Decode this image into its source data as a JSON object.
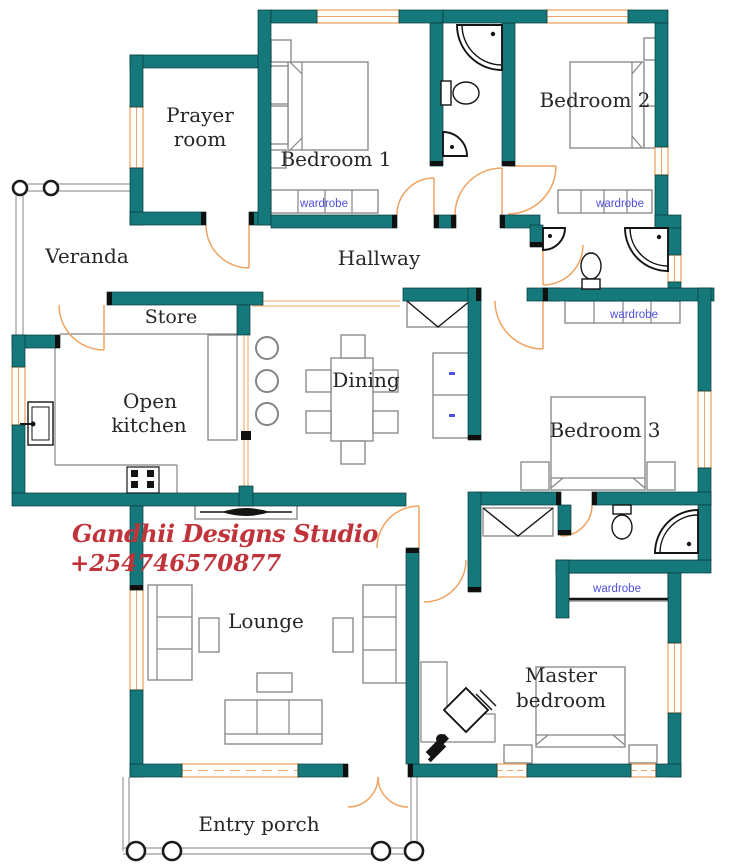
{
  "colors": {
    "wall": "#15797b",
    "window": "#efa463",
    "furniture": "#848484",
    "fixture": "#141414",
    "label": "#262626",
    "wardrobe_text": "#4f4fe0",
    "watermark": "#c0333a",
    "background": "#ffffff"
  },
  "rooms": {
    "prayer_room": {
      "line1": "Prayer",
      "line2": "room"
    },
    "bedroom1": {
      "label": "Bedroom 1"
    },
    "bedroom2": {
      "label": "Bedroom 2"
    },
    "veranda": {
      "label": "Veranda"
    },
    "hallway": {
      "label": "Hallway"
    },
    "store": {
      "label": "Store"
    },
    "open_kitchen": {
      "line1": "Open",
      "line2": "kitchen"
    },
    "dining": {
      "label": "Dining"
    },
    "bedroom3": {
      "label": "Bedroom 3"
    },
    "lounge": {
      "label": "Lounge"
    },
    "master_bedroom": {
      "line1": "Master",
      "line2": "bedroom"
    },
    "entry_porch": {
      "label": "Entry porch"
    }
  },
  "wardrobes": {
    "bedroom1": "wardrobe",
    "bedroom2": "wardrobe",
    "bedroom3": "wardrobe",
    "master": "wardrobe"
  },
  "watermark": {
    "studio": "Gandhii Designs Studio",
    "phone": "+254746570877"
  }
}
